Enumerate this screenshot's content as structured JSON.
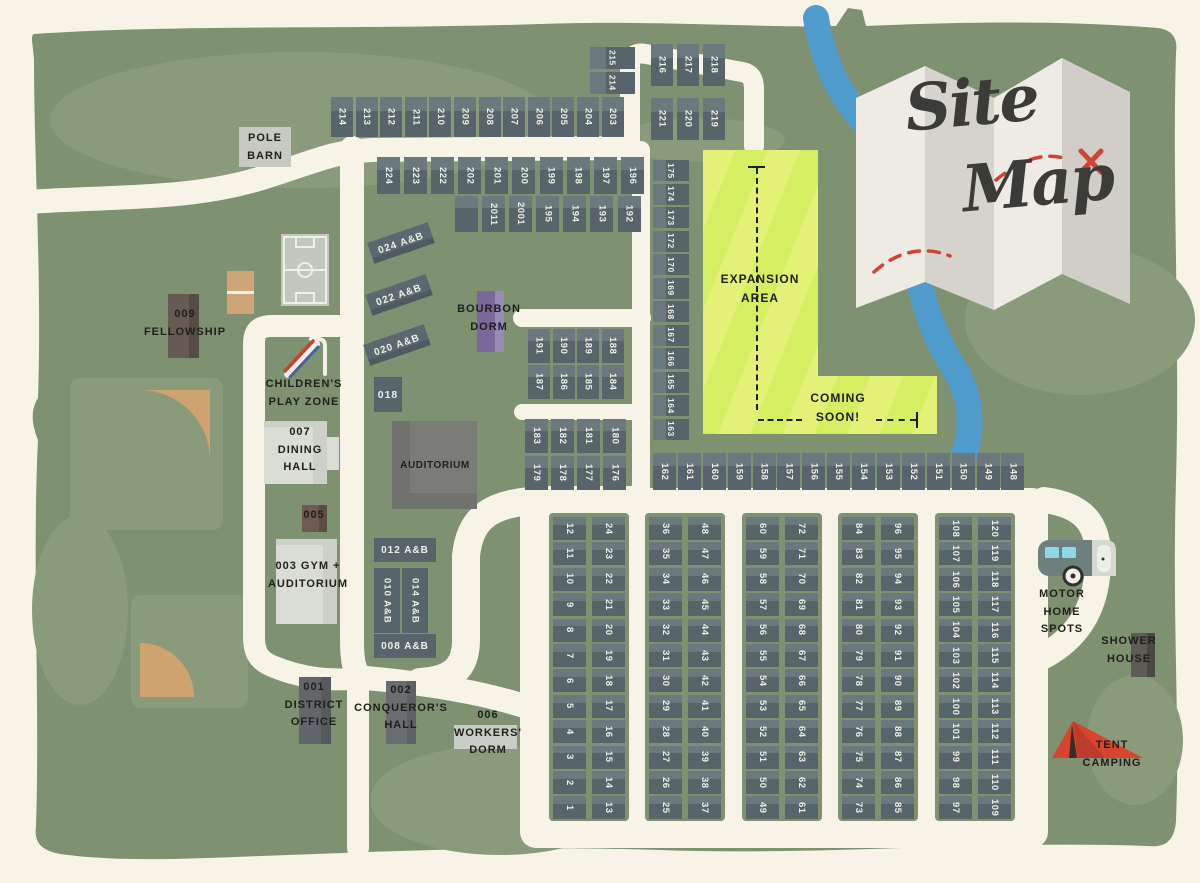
{
  "title": {
    "word1": "Site",
    "word2": "Map"
  },
  "labels": {
    "pole_barn": [
      "POLE",
      "BARN"
    ],
    "fellowship": [
      "009",
      "FELLOWSHIP"
    ],
    "childrens_play_zone": [
      "CHILDREN'S",
      "PLAY ZONE"
    ],
    "dining_hall": [
      "007",
      "DINING",
      "HALL"
    ],
    "b005": "005",
    "gym": [
      "003 GYM +",
      "AUDITORIUM"
    ],
    "auditorium": "AUDITORIUM",
    "b018": "018",
    "b024": "024 A&B",
    "b022": "022 A&B",
    "b020": "020 A&B",
    "bourbon_dorm": [
      "BOURBON",
      "DORM"
    ],
    "b012": "012 A&B",
    "b010": "010 A&B",
    "b014": "014 A&B",
    "b008": "008 A&B",
    "district_office": [
      "001",
      "DISTRICT",
      "OFFICE"
    ],
    "conquerors_hall": [
      "002",
      "CONQUEROR'S",
      "HALL"
    ],
    "workers_dorm": [
      "006",
      "WORKERS'",
      "DORM"
    ],
    "expansion_area": [
      "EXPANSION",
      "AREA"
    ],
    "coming_soon": [
      "COMING",
      "SOON!"
    ],
    "motor_home": [
      "MOTOR",
      "HOME",
      "SPOTS"
    ],
    "shower_house": [
      "SHOWER",
      "HOUSE"
    ],
    "tent_camping": [
      "TENT",
      "CAMPING"
    ]
  },
  "sites": {
    "row_north": [
      "214",
      "213",
      "212",
      "211",
      "210",
      "209",
      "208",
      "207",
      "206",
      "205",
      "204",
      "203"
    ],
    "pair_ne": [
      "215",
      "214"
    ],
    "block_ne_r1": [
      "216",
      "217",
      "218"
    ],
    "block_ne_r2": [
      "221",
      "220",
      "219"
    ],
    "row_mid_r1": [
      "224",
      "223",
      "222",
      "202",
      "201",
      "200",
      "199",
      "198",
      "197",
      "196"
    ],
    "row_mid_r2": [
      "",
      "2011",
      "2001",
      "195",
      "194",
      "193",
      "192"
    ],
    "block_188_r1": [
      "191",
      "190",
      "189",
      "188"
    ],
    "block_188_r2": [
      "187",
      "186",
      "185",
      "184"
    ],
    "block_180_r1": [
      "183",
      "182",
      "181",
      "180"
    ],
    "block_180_r2": [
      "179",
      "178",
      "177",
      "176"
    ],
    "col_east": [
      "175",
      "174",
      "173",
      "172",
      "170",
      "169",
      "168",
      "167",
      "166",
      "165",
      "164",
      "163"
    ],
    "row_south": [
      "162",
      "161",
      "160",
      "159",
      "158",
      "157",
      "156",
      "155",
      "154",
      "153",
      "152",
      "151",
      "150",
      "149",
      "148"
    ],
    "grid_cols": [
      [
        "12",
        "11",
        "10",
        "9",
        "8",
        "7",
        "6",
        "5",
        "4",
        "3",
        "2",
        "1"
      ],
      [
        "24",
        "23",
        "22",
        "21",
        "20",
        "19",
        "18",
        "17",
        "16",
        "15",
        "14",
        "13"
      ],
      [
        "36",
        "35",
        "34",
        "33",
        "32",
        "31",
        "30",
        "29",
        "28",
        "27",
        "26",
        "25"
      ],
      [
        "48",
        "47",
        "46",
        "45",
        "44",
        "43",
        "42",
        "41",
        "40",
        "39",
        "38",
        "37"
      ],
      [
        "60",
        "59",
        "58",
        "57",
        "56",
        "55",
        "54",
        "53",
        "52",
        "51",
        "50",
        "49"
      ],
      [
        "72",
        "71",
        "70",
        "69",
        "68",
        "67",
        "66",
        "65",
        "64",
        "63",
        "62",
        "61"
      ],
      [
        "84",
        "83",
        "82",
        "81",
        "80",
        "79",
        "78",
        "77",
        "76",
        "75",
        "74",
        "73"
      ],
      [
        "96",
        "95",
        "94",
        "93",
        "92",
        "91",
        "90",
        "89",
        "88",
        "87",
        "86",
        "85"
      ],
      [
        "108",
        "107",
        "106",
        "105",
        "104",
        "103",
        "102",
        "100",
        "101",
        "99",
        "98",
        "97"
      ],
      [
        "120",
        "119",
        "118",
        "117",
        "116",
        "115",
        "114",
        "113",
        "112",
        "111",
        "110",
        "109"
      ]
    ]
  },
  "colors": {
    "background": "#f7f3e6",
    "land": "#7e9170",
    "land_light": "#8a9b7b",
    "road": "#f7f3e6",
    "site_fill": "#57646a",
    "site_fill_light": "#6b797e",
    "site_text": "#eef0e4",
    "expansion_stripe_a": "#e3f277",
    "expansion_stripe_b": "#d5ee62",
    "river": "#4f9ccd",
    "paper_light": "#edebe3",
    "paper_dark": "#d5d3cc",
    "route_red": "#d14334",
    "tent_red": "#d8452f",
    "title_ink": "#3b3b38",
    "label_ink": "#1f1f1c",
    "court_tan": "#cfa577",
    "building_light": "#d9ddd5",
    "building_dark": "#7b7b78",
    "fellowship_brown": "#665a53",
    "bourbon_purple": "#79699b"
  }
}
